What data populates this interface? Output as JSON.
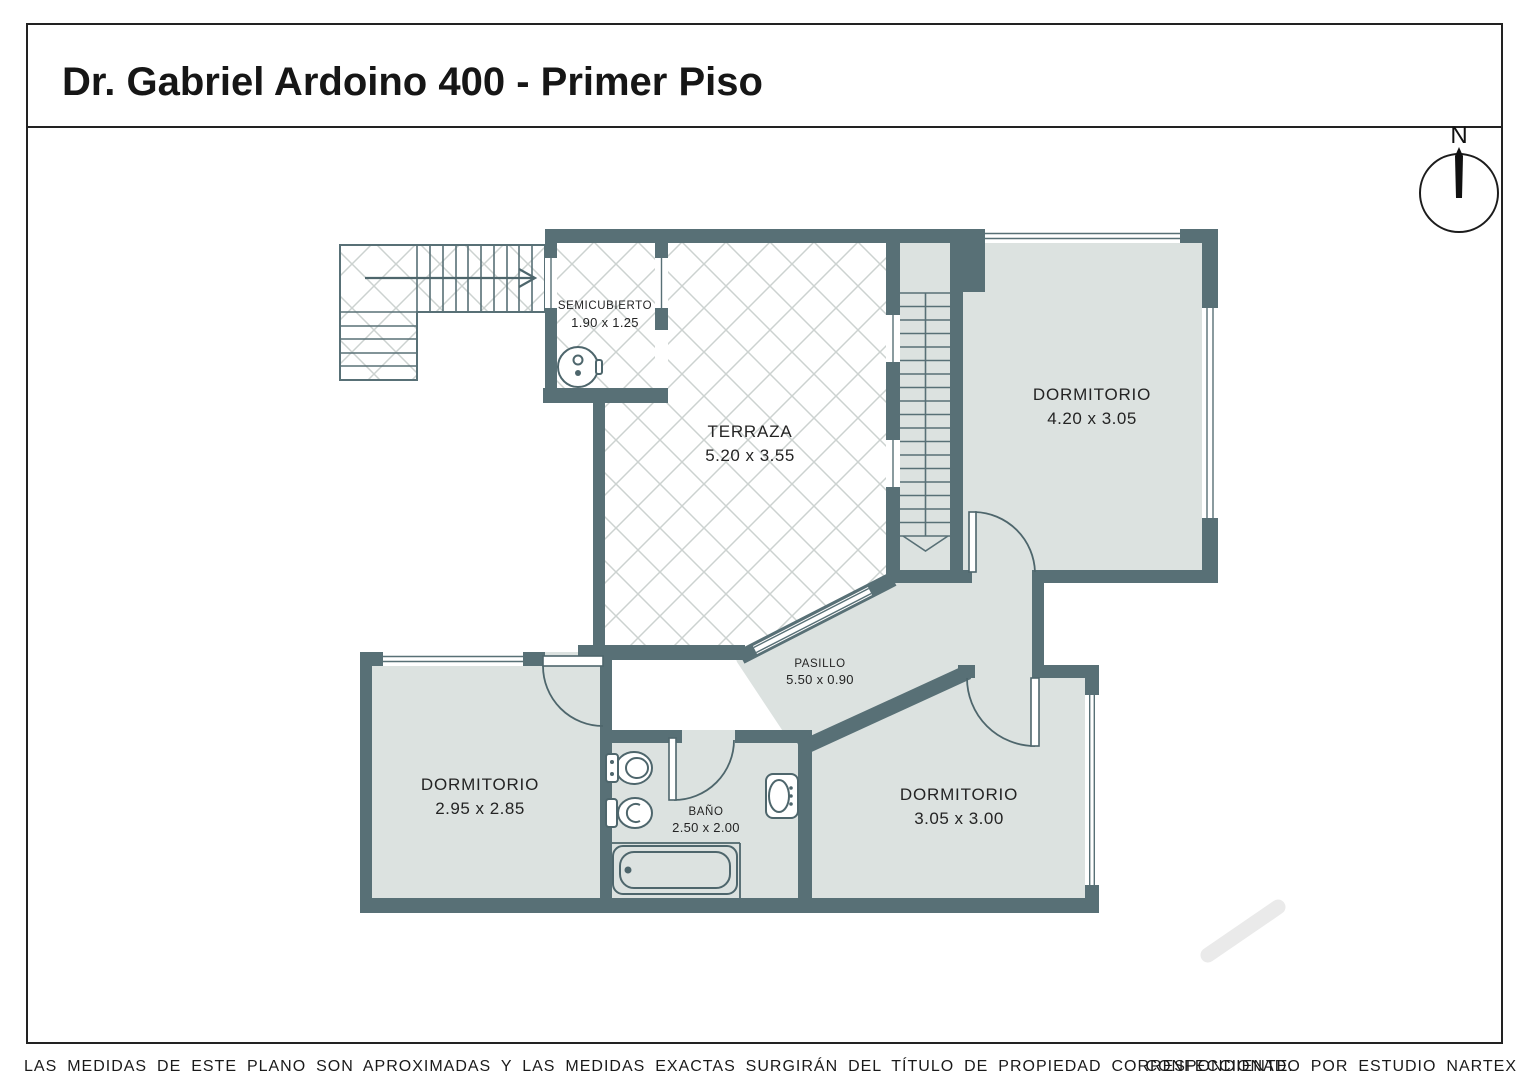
{
  "title": "Dr. Gabriel Ardoino 400 - Primer Piso",
  "compass": {
    "north_label": "N"
  },
  "rooms": [
    {
      "id": "semicubierto",
      "name": "SEMICUBIERTO",
      "dims": "1.90 x 1.25"
    },
    {
      "id": "terraza",
      "name": "TERRAZA",
      "dims": "5.20 x 3.55"
    },
    {
      "id": "dormitorio-1",
      "name": "DORMITORIO",
      "dims": "4.20 x 3.05"
    },
    {
      "id": "pasillo",
      "name": "PASILLO",
      "dims": "5.50 x 0.90"
    },
    {
      "id": "dormitorio-2",
      "name": "DORMITORIO",
      "dims": "2.95 x 2.85"
    },
    {
      "id": "bano",
      "name": "BAÑO",
      "dims": "2.50 x 2.00"
    },
    {
      "id": "dormitorio-3",
      "name": "DORMITORIO",
      "dims": "3.05 x 3.00"
    }
  ],
  "footer": {
    "disclaimer": "LAS MEDIDAS DE ESTE PLANO SON APROXIMADAS Y LAS MEDIDAS EXACTAS SURGIRÁN DEL TÍTULO DE PROPIEDAD CORRESPONDIENTE.",
    "credit": "CONFECCIONADO POR ESTUDIO NARTEX"
  },
  "colors": {
    "wall": "#587076",
    "room_fill": "#dce2e0",
    "lattice_line": "#ccd2d0",
    "outline": "#4e666c",
    "border": "#222222",
    "watermark": "#eaeaea"
  }
}
